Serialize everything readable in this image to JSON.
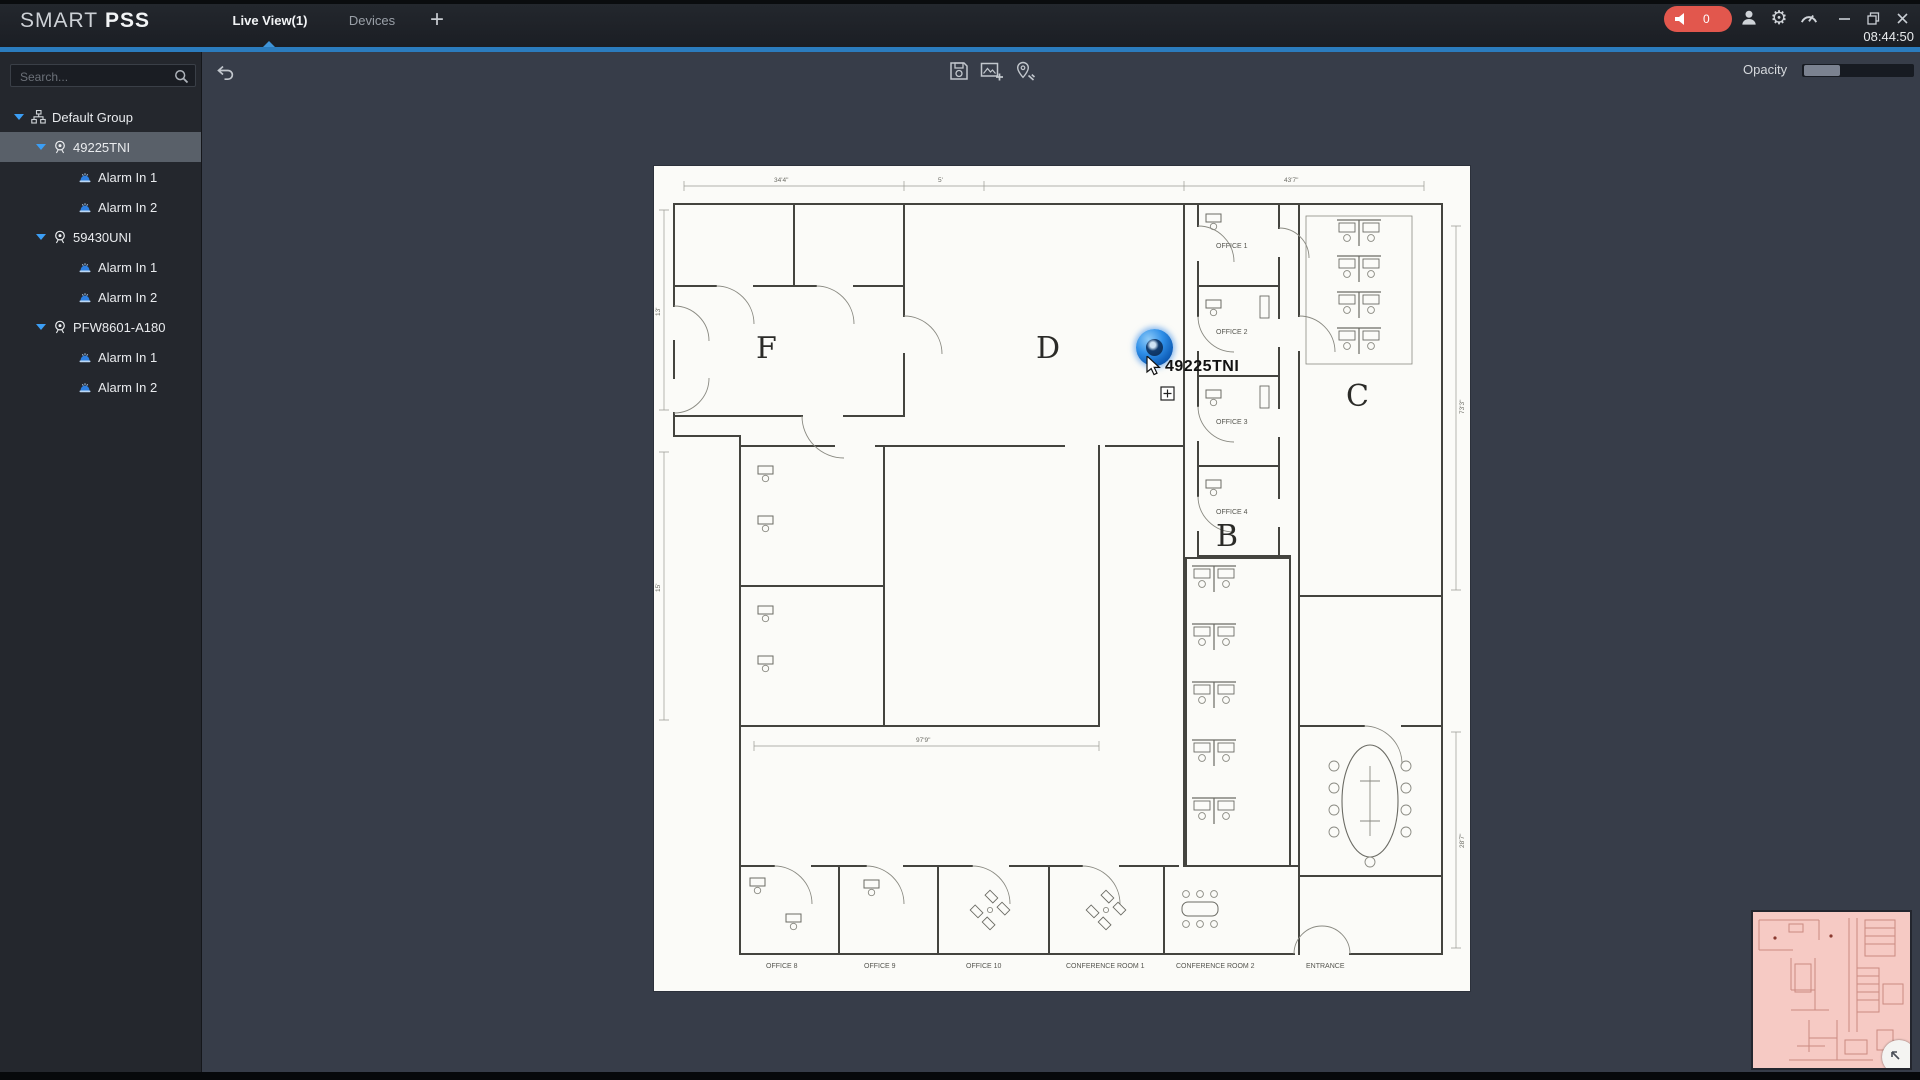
{
  "topbar": {
    "brand_a": "SMART",
    "brand_b": "PSS",
    "alarm_count": "0",
    "clock": "08:44:50",
    "add_tab": "+"
  },
  "tabs": [
    {
      "label": "Live View(1)",
      "active": true
    },
    {
      "label": "Devices",
      "active": false
    }
  ],
  "sidebar": {
    "search_placeholder": "Search...",
    "tree": [
      {
        "label": "Default Group",
        "type": "group",
        "level": 0,
        "selected": false
      },
      {
        "label": "49225TNI",
        "type": "device",
        "level": 1,
        "selected": true
      },
      {
        "label": "Alarm In 1",
        "type": "alarm",
        "level": 2,
        "selected": false
      },
      {
        "label": "Alarm In 2",
        "type": "alarm",
        "level": 2,
        "selected": false
      },
      {
        "label": "59430UNI",
        "type": "device",
        "level": 1,
        "selected": false
      },
      {
        "label": "Alarm In 1",
        "type": "alarm",
        "level": 2,
        "selected": false
      },
      {
        "label": "Alarm In 2",
        "type": "alarm",
        "level": 2,
        "selected": false
      },
      {
        "label": "PFW8601-A180",
        "type": "device",
        "level": 1,
        "selected": false
      },
      {
        "label": "Alarm In 1",
        "type": "alarm",
        "level": 2,
        "selected": false
      },
      {
        "label": "Alarm In 2",
        "type": "alarm",
        "level": 2,
        "selected": false
      }
    ]
  },
  "toolbar": {
    "opacity_label": "Opacity"
  },
  "map": {
    "marker_label": "49225TNI",
    "areas": {
      "f": "F",
      "d": "D",
      "c": "C",
      "b": "B"
    },
    "offices": [
      "OFFICE 1",
      "OFFICE 2",
      "OFFICE 3",
      "OFFICE 4"
    ],
    "rooms": [
      "OFFICE 8",
      "OFFICE 9",
      "OFFICE 10",
      "CONFERENCE ROOM 1",
      "CONFERENCE ROOM 2"
    ],
    "entrance": "ENTRANCE",
    "dims": [
      "34'4\"",
      "5'",
      "43'7\"",
      "13'",
      "15'",
      "73'3\"",
      "28'7\"",
      "97'9\""
    ]
  }
}
